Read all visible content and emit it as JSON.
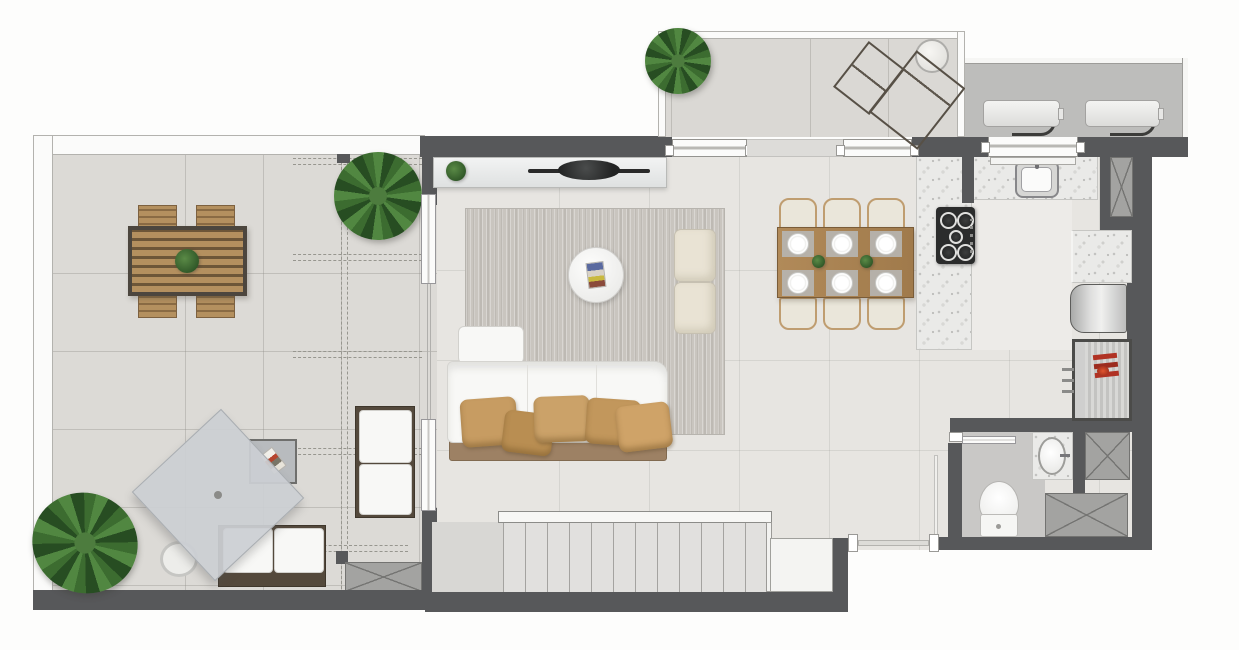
{
  "canvas": {
    "width": 1239,
    "height": 650
  },
  "palette": {
    "wall": "#57585a",
    "terrace_floor": "#dcdad6",
    "interior_floor": "#e7e5e1",
    "kitchen_floor": "#edebe8",
    "bath_floor": "#c9c8c6",
    "ac_floor": "#bdbdbb",
    "balcony_floor": "#dad8d4",
    "terrazzo": "#eaeae8",
    "frame_white": "#fbfbfa",
    "wood": "#ab8a5e",
    "wood_dark": "#54493c",
    "sofa_white": "#f8f8f6",
    "pillow_tan": "#c59a60",
    "rug": "#c9c5bf",
    "pouf": "#e9e3d4",
    "stair_floor": "#e1e0de",
    "shaft_grey": "#a3a3a1",
    "parasol": "#cbd0d3",
    "sunbed_brown": "#8a8173",
    "plant_green": "#3c6c30",
    "clothes_red": "#b03224",
    "landing": "#f4f4f2"
  },
  "floor_plan": {
    "type": "apartment-top-view-render",
    "rooms": [
      {
        "id": "terrace",
        "features": [
          "outdoor-dining-table",
          "four-outdoor-chairs",
          "pergola-dashed-beams",
          "large-plant",
          "corner-plant",
          "parasol",
          "side-table",
          "garden-bench",
          "daybed-bench",
          "service-shaft"
        ]
      },
      {
        "id": "living-room",
        "features": [
          "tv-sideboard",
          "tv",
          "area-rug",
          "sofa-with-pillows",
          "chaise",
          "round-coffee-table",
          "two-ottomans"
        ]
      },
      {
        "id": "dining-area",
        "features": [
          "wood-dining-table",
          "six-chairs",
          "six-place-settings",
          "two-centerpieces"
        ]
      },
      {
        "id": "kitchen",
        "features": [
          "u-shaped-terrazzo-counter",
          "gas-cooktop",
          "sink",
          "window",
          "refrigerator",
          "duct-shaft"
        ]
      },
      {
        "id": "balcony",
        "features": [
          "plant",
          "two-sun-loungers",
          "round-side-table"
        ]
      },
      {
        "id": "service-area",
        "features": [
          "ac-condenser-1",
          "ac-condenser-2",
          "pipes"
        ]
      },
      {
        "id": "hall",
        "features": [
          "wardrobe-with-red-clothes",
          "entry-threshold"
        ]
      },
      {
        "id": "bathroom",
        "features": [
          "sliding-door",
          "toilet",
          "terrazzo-vanity-sink",
          "duct-shaft-small",
          "duct-shaft-wide"
        ]
      },
      {
        "id": "staircase",
        "features": [
          "thirteen-treads",
          "handrail-band",
          "landing"
        ]
      }
    ]
  }
}
